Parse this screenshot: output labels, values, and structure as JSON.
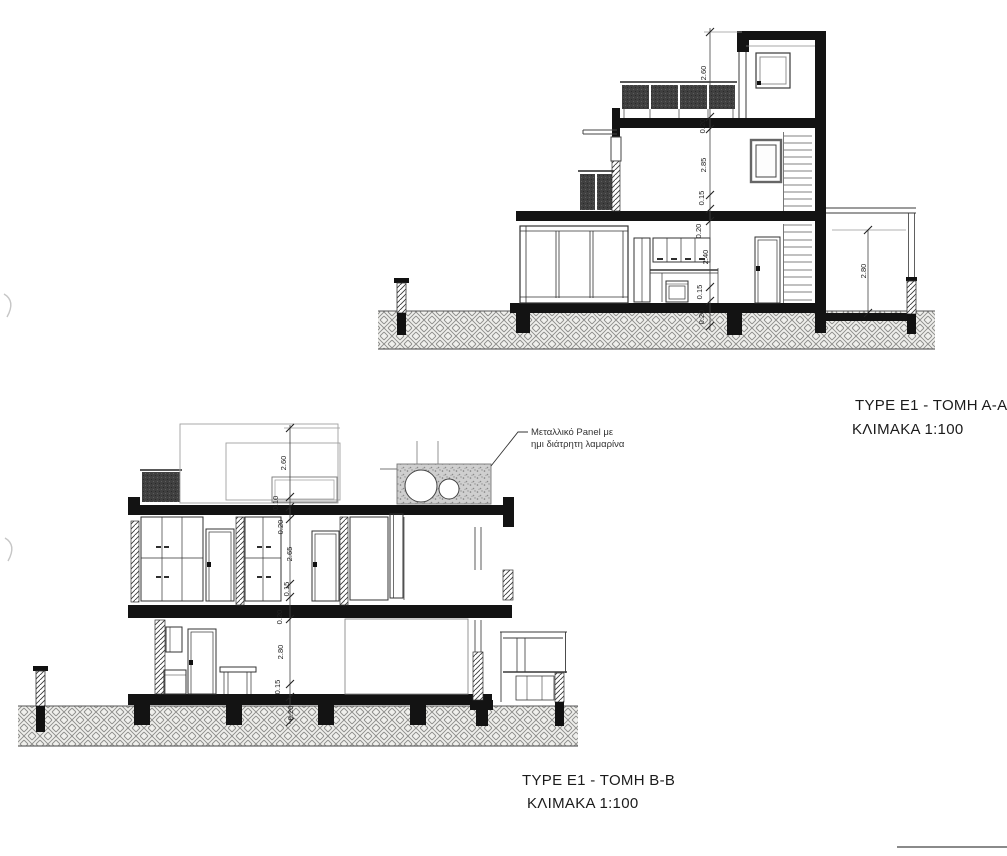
{
  "sheet": {
    "background": "#ffffff",
    "line_color": "#1a1a1a"
  },
  "section_aa": {
    "title": "TYPE E1 - TOMH A-A",
    "scale": "ΚΛΙΜΑΚΑ 1:100",
    "dims": [
      "2.60",
      "0.20",
      "2.85",
      "0.15",
      "0.20",
      "2.40",
      "0.15",
      "0.20"
    ],
    "pergola_dim": "2.80"
  },
  "section_bb": {
    "title": "TYPE E1 - TOMH B-B",
    "scale": "ΚΛΙΜΑΚΑ 1:100",
    "dims": [
      "2.60",
      "0.10",
      "0.20",
      "2.65",
      "0.15",
      "0.20",
      "2.80",
      "0.15",
      "0.20"
    ],
    "annotation": [
      "Μεταλλικό Panel με",
      "ημι διάτρητη λαμαρίνα"
    ]
  }
}
